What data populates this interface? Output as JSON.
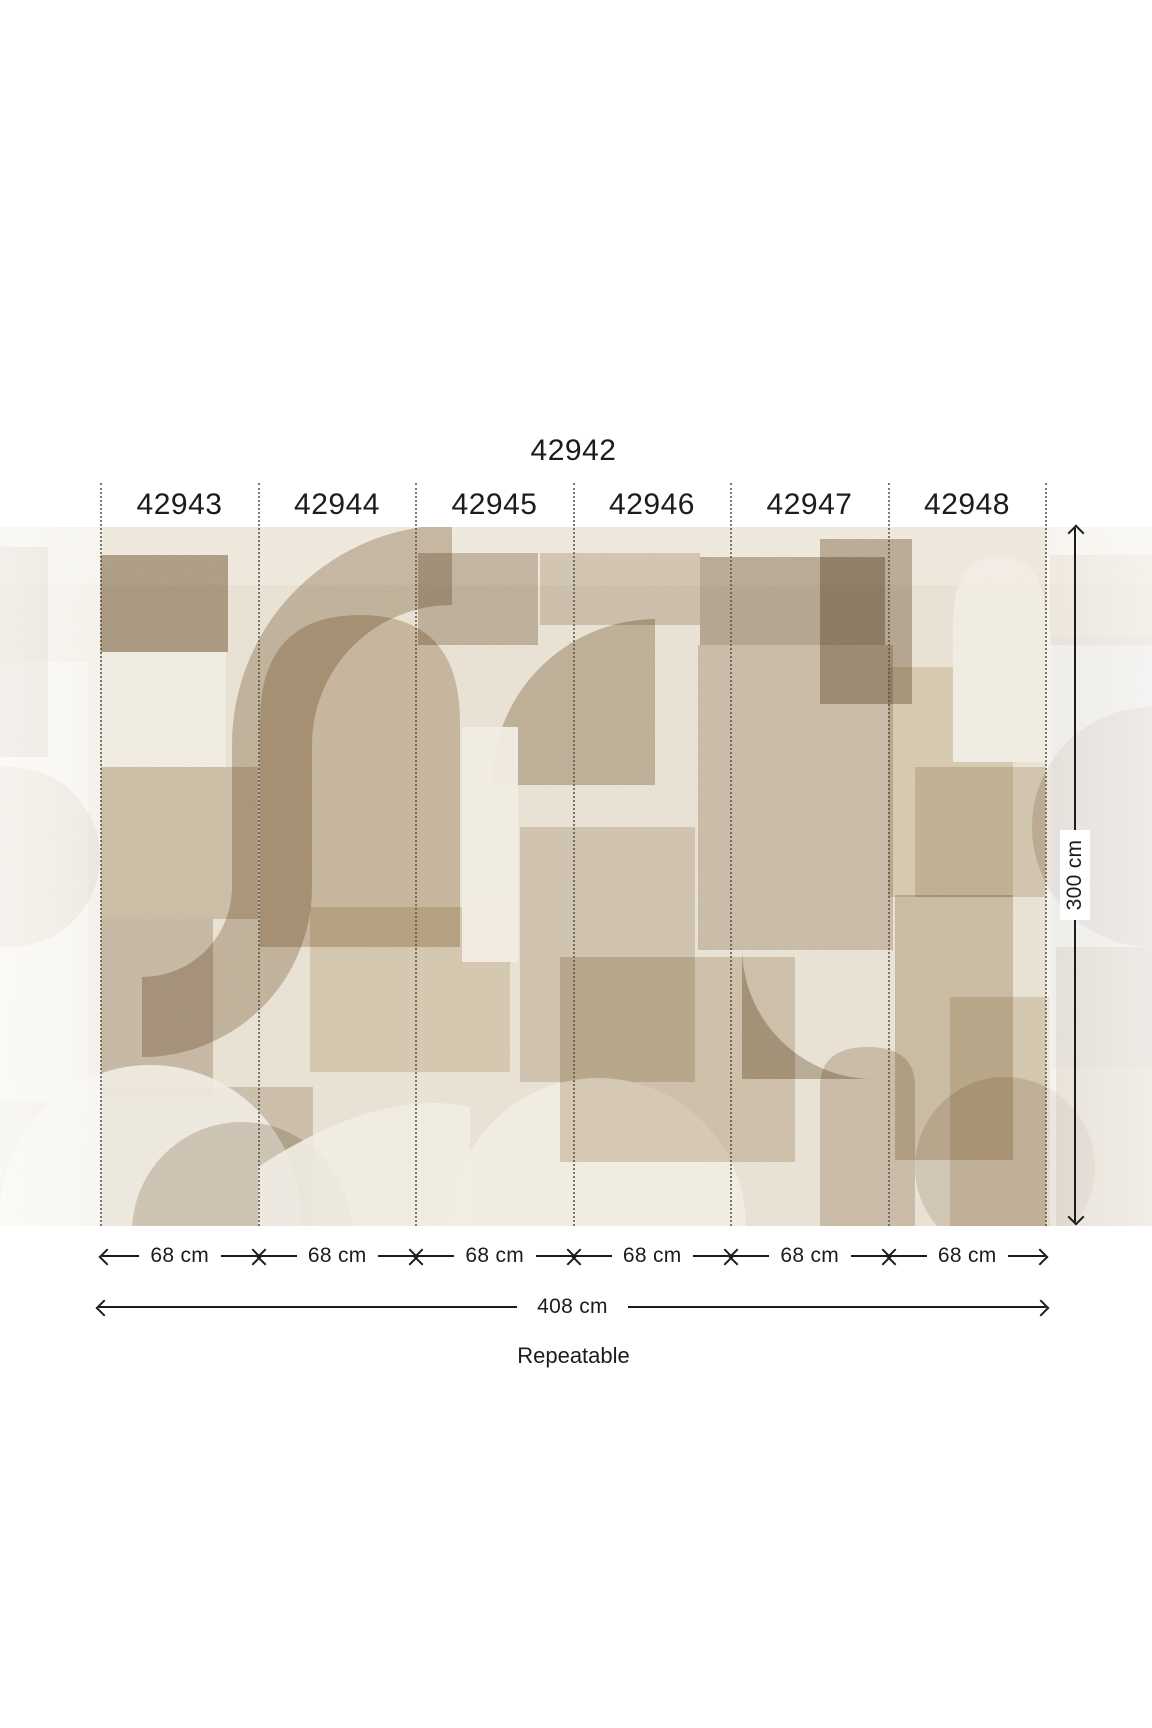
{
  "mural": {
    "code": "42942"
  },
  "panels": [
    {
      "code": "42943",
      "width_label": "68 cm"
    },
    {
      "code": "42944",
      "width_label": "68 cm"
    },
    {
      "code": "42945",
      "width_label": "68 cm"
    },
    {
      "code": "42946",
      "width_label": "68 cm"
    },
    {
      "code": "42947",
      "width_label": "68 cm"
    },
    {
      "code": "42948",
      "width_label": "68 cm"
    }
  ],
  "dimensions": {
    "total_width": "408 cm",
    "height": "300 cm",
    "repeat_note": "Repeatable"
  },
  "colors": {
    "text": "#1c1c1c",
    "dimension_line": "#1c1c1c",
    "panel_divider": "#5f5951",
    "label_background": "#ffffff",
    "mural_base": "#eae3d5",
    "mural_palette": [
      "#f3eee5",
      "#e6dccb",
      "#d5c8b4",
      "#c0b19c",
      "#a7977f"
    ],
    "fade_overlay": "rgba(255,255,255,0.62)"
  }
}
